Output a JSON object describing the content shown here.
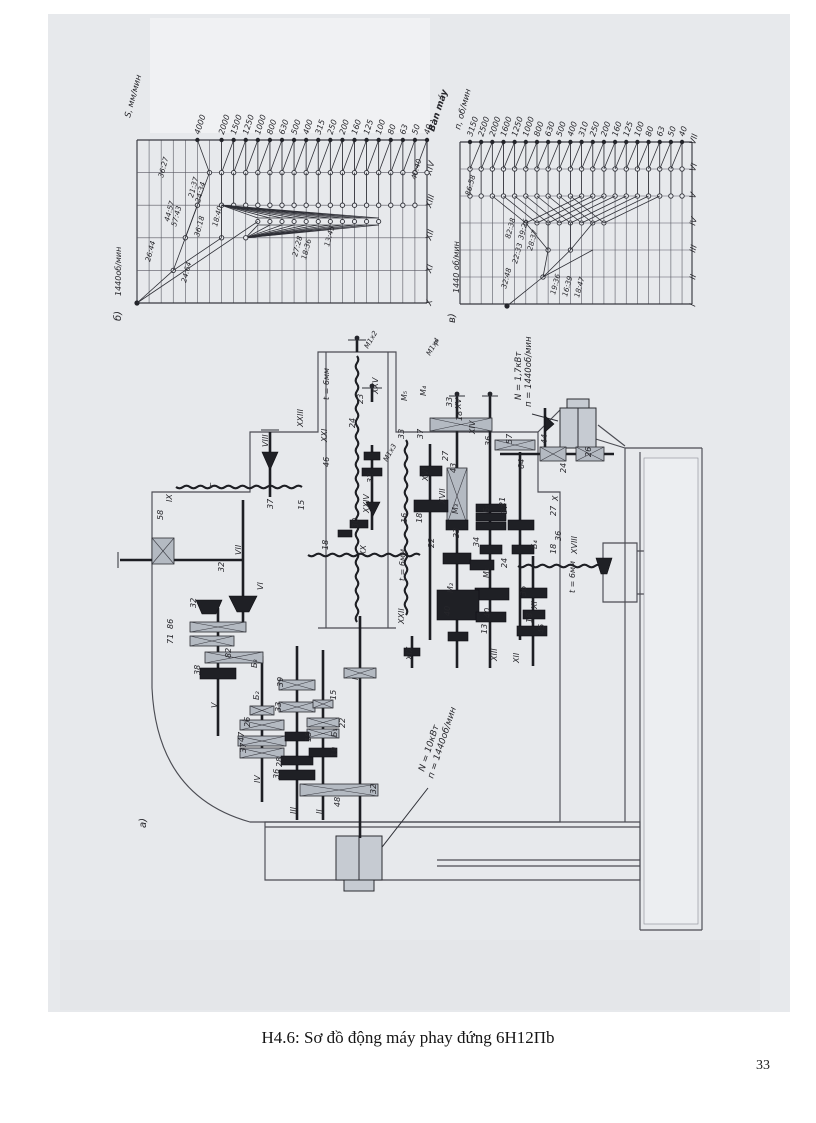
{
  "page": {
    "caption": "H4.6: Sơ đồ động máy phay đứng 6H12Пb",
    "page_number": "33"
  },
  "chart_data": [
    {
      "type": "line",
      "variant": "speed-structure-ray-diagram-feeds",
      "corner_label": "б)",
      "axis_label": "S, мм/мин",
      "source_label": "1440об/мин",
      "output_label": "Bàn máy",
      "tick_labels": [
        "4000",
        "2000",
        "1500",
        "1250",
        "1000",
        "800",
        "630",
        "500",
        "400",
        "315",
        "250",
        "200",
        "160",
        "125",
        "100",
        "80",
        "63",
        "50",
        "40"
      ],
      "shaft_labels": [
        "XIV",
        "XIII",
        "XII",
        "XI",
        "X"
      ],
      "ratio_labels": [
        {
          "t": "36:27",
          "x": 163,
          "y": 178
        },
        {
          "t": "44:57",
          "x": 169,
          "y": 222
        },
        {
          "t": "57:43",
          "x": 176,
          "y": 227
        },
        {
          "t": "26:44",
          "x": 150,
          "y": 262
        },
        {
          "t": "24:64",
          "x": 186,
          "y": 283
        },
        {
          "t": "21:37",
          "x": 193,
          "y": 198
        },
        {
          "t": "24:34",
          "x": 200,
          "y": 203
        },
        {
          "t": "36:18",
          "x": 199,
          "y": 237
        },
        {
          "t": "18:40",
          "x": 217,
          "y": 227
        },
        {
          "t": "27:28",
          "x": 297,
          "y": 257
        },
        {
          "t": "18:36",
          "x": 306,
          "y": 260
        },
        {
          "t": "13:45",
          "x": 329,
          "y": 247
        },
        {
          "t": "40:40",
          "x": 416,
          "y": 180
        }
      ]
    },
    {
      "type": "line",
      "variant": "speed-structure-ray-diagram-spindle",
      "corner_label": "в)",
      "axis_label": "п, об/мин",
      "source_label": "1440 об/мин",
      "output_label": "",
      "tick_labels": [
        "3150",
        "2500",
        "2000",
        "1600",
        "1250",
        "1000",
        "800",
        "630",
        "500",
        "400",
        "310",
        "250",
        "200",
        "160",
        "125",
        "100",
        "80",
        "63",
        "50",
        "40"
      ],
      "shaft_labels": [
        "VII",
        "VI",
        "V",
        "IV",
        "III",
        "II",
        "I"
      ],
      "ratio_labels": [
        {
          "t": "86:58",
          "x": 470,
          "y": 196
        },
        {
          "t": "82:38",
          "x": 510,
          "y": 239
        },
        {
          "t": "39:26",
          "x": 523,
          "y": 240
        },
        {
          "t": "22:33",
          "x": 517,
          "y": 264
        },
        {
          "t": "28:37",
          "x": 532,
          "y": 251
        },
        {
          "t": "32:48",
          "x": 506,
          "y": 289
        },
        {
          "t": "19:36",
          "x": 555,
          "y": 295
        },
        {
          "t": "16:39",
          "x": 567,
          "y": 297
        },
        {
          "t": "18:47",
          "x": 579,
          "y": 298
        }
      ]
    }
  ],
  "diagram": {
    "main_motor_label_1": "N = 10кВт",
    "main_motor_label_2": "п = 1440об/мин",
    "feed_motor_label_1": "N = 1,7кВт",
    "feed_motor_label_2": "п = 1440об/мин",
    "annotations": [
      [
        "IX",
        172,
        502
      ],
      [
        "Г",
        215,
        487,
        -90,
        7
      ],
      [
        "37",
        273,
        509
      ],
      [
        "58",
        163,
        520
      ],
      [
        "VIII",
        268,
        447
      ],
      [
        "VII",
        241,
        555
      ],
      [
        "32",
        224,
        572
      ],
      [
        "VI",
        263,
        590
      ],
      [
        "32",
        196,
        608
      ],
      [
        "V",
        217,
        708
      ],
      [
        "38",
        200,
        675
      ],
      [
        "82",
        231,
        658
      ],
      [
        "71",
        173,
        644
      ],
      [
        "86",
        173,
        629
      ],
      [
        "Б₃",
        257,
        668
      ],
      [
        "39",
        283,
        687
      ],
      [
        "33",
        281,
        712
      ],
      [
        "Б₂",
        259,
        700
      ],
      [
        "26",
        250,
        727
      ],
      [
        "47",
        244,
        742
      ],
      [
        "37",
        246,
        753
      ],
      [
        "18",
        311,
        742
      ],
      [
        "28",
        282,
        767
      ],
      [
        "36",
        279,
        779
      ],
      [
        "IV",
        260,
        783
      ],
      [
        "15",
        336,
        700
      ],
      [
        "Б₁",
        337,
        737
      ],
      [
        "22",
        345,
        728
      ],
      [
        "19",
        337,
        757
      ],
      [
        "III",
        296,
        814
      ],
      [
        "II",
        322,
        814
      ],
      [
        "I",
        358,
        680
      ],
      [
        "32",
        376,
        794
      ],
      [
        "48",
        340,
        807
      ],
      [
        "а)",
        146,
        828,
        -90,
        10
      ],
      [
        "XXIII",
        303,
        427
      ],
      [
        "t = 6мм",
        329,
        400
      ],
      [
        "XXI",
        327,
        442
      ],
      [
        "46",
        329,
        467
      ],
      [
        "XXV",
        378,
        394
      ],
      [
        "23",
        363,
        404
      ],
      [
        "24",
        355,
        428
      ],
      [
        "32",
        373,
        483
      ],
      [
        "XXIV",
        369,
        513
      ],
      [
        "30",
        358,
        528
      ],
      [
        "15",
        304,
        510
      ],
      [
        "18",
        328,
        550
      ],
      [
        "XX",
        366,
        556
      ],
      [
        "М1х2",
        368,
        349,
        -60,
        7
      ],
      [
        "М1х3",
        387,
        462,
        -60,
        7
      ],
      [
        "М1х4",
        430,
        356,
        -60,
        7
      ],
      [
        "Р",
        438,
        346,
        -60,
        7
      ],
      [
        "М₅",
        407,
        401
      ],
      [
        "М₄",
        426,
        396
      ],
      [
        "33",
        404,
        439
      ],
      [
        "37",
        423,
        439
      ],
      [
        "33",
        452,
        407
      ],
      [
        "XV",
        461,
        409
      ],
      [
        "18",
        462,
        421
      ],
      [
        "XIV",
        475,
        434
      ],
      [
        "27",
        448,
        461
      ],
      [
        "43",
        456,
        473
      ],
      [
        "36",
        491,
        446
      ],
      [
        "57",
        512,
        444
      ],
      [
        "64",
        524,
        469
      ],
      [
        "44",
        547,
        444
      ],
      [
        "26",
        591,
        457
      ],
      [
        "24",
        566,
        473
      ],
      [
        "X",
        558,
        501
      ],
      [
        "27",
        556,
        516
      ],
      [
        "XVI",
        428,
        481
      ],
      [
        "XVII",
        445,
        504
      ],
      [
        "М₃",
        458,
        514
      ],
      [
        "21",
        505,
        507
      ],
      [
        "37",
        507,
        514
      ],
      [
        "Б₅",
        489,
        513
      ],
      [
        "33",
        459,
        538
      ],
      [
        "34",
        479,
        547
      ],
      [
        "22",
        434,
        548
      ],
      [
        "16",
        407,
        523
      ],
      [
        "18",
        422,
        523
      ],
      [
        "Б₄",
        537,
        549
      ],
      [
        "36",
        561,
        541
      ],
      [
        "18",
        556,
        554
      ],
      [
        "XVIII",
        577,
        554
      ],
      [
        "t = 6мм",
        575,
        593
      ],
      [
        "М₁",
        489,
        578
      ],
      [
        "24",
        507,
        568
      ],
      [
        "М₂",
        453,
        593
      ],
      [
        "36",
        526,
        596
      ],
      [
        "40",
        450,
        616
      ],
      [
        "40",
        490,
        618
      ],
      [
        "13",
        487,
        634
      ],
      [
        "45",
        544,
        634
      ],
      [
        "18",
        532,
        623
      ],
      [
        "XI",
        537,
        609
      ],
      [
        "XIII",
        497,
        661
      ],
      [
        "XII",
        519,
        663
      ],
      [
        "XIX",
        412,
        660
      ],
      [
        "XXII",
        404,
        624
      ],
      [
        "t = 6мм",
        405,
        581
      ],
      [
        "N = 10кВт",
        424,
        772,
        -72,
        9
      ],
      [
        "п = 1440об/мин",
        433,
        779,
        -72,
        9
      ],
      [
        "N = 1,7кВт",
        521,
        400,
        -90,
        8.5
      ],
      [
        "п = 1440об/мин",
        531,
        407,
        -90,
        8.5
      ]
    ]
  }
}
